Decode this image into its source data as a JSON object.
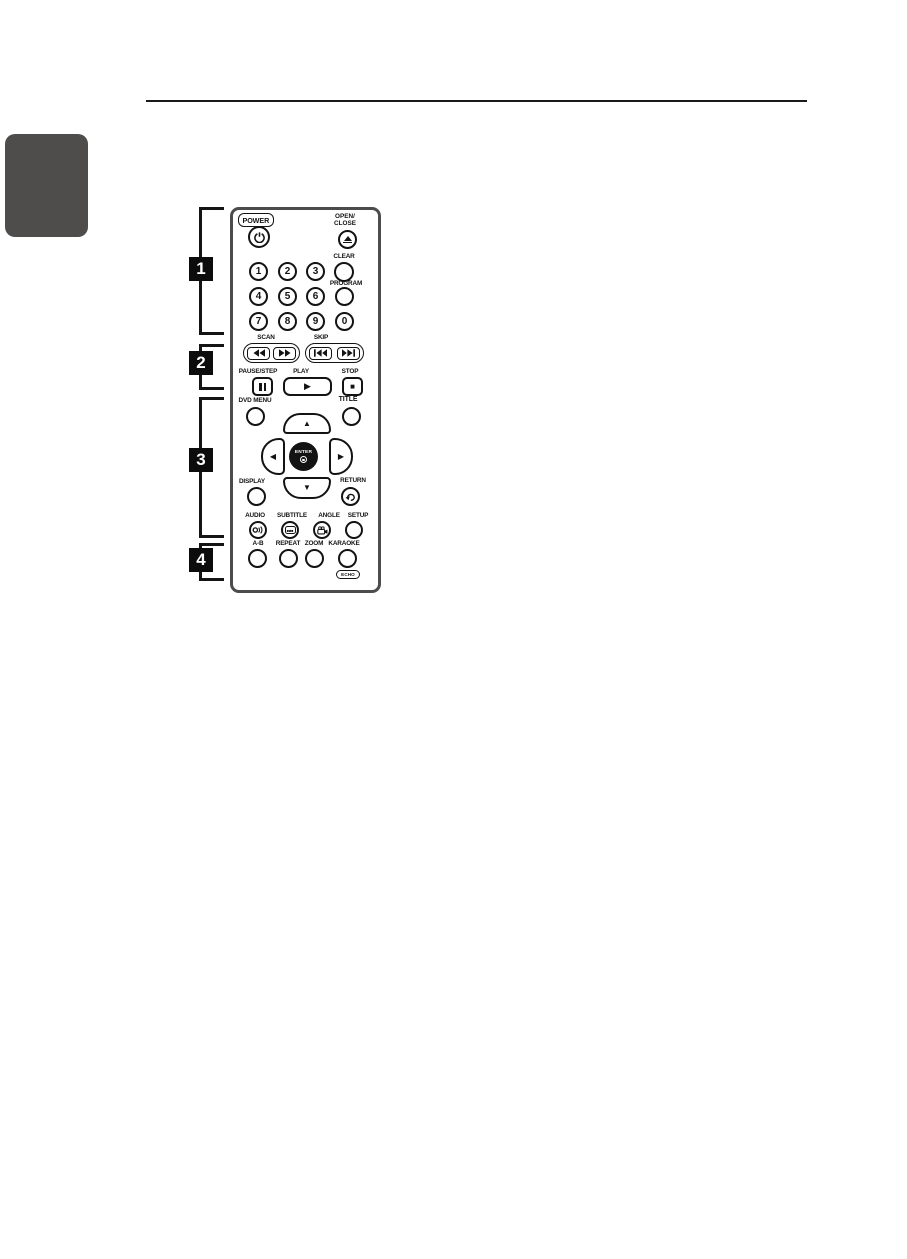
{
  "page": {
    "sections": [
      {
        "number": "1"
      },
      {
        "number": "2"
      },
      {
        "number": "3"
      },
      {
        "number": "4"
      }
    ]
  },
  "remote": {
    "power_label": "POWER",
    "open_close_line1": "OPEN/",
    "open_close_line2": "CLOSE",
    "digits": [
      "1",
      "2",
      "3",
      "4",
      "5",
      "6",
      "7",
      "8",
      "9",
      "0"
    ],
    "clear_label": "CLEAR",
    "program_label": "PROGRAM",
    "scan_label": "SCAN",
    "skip_label": "SKIP",
    "pause_step_label": "PAUSE/STEP",
    "play_label": "PLAY",
    "stop_label": "STOP",
    "dvd_menu_label": "DVD MENU",
    "title_label": "TITLE",
    "enter_label": "ENTER",
    "display_label": "DISPLAY",
    "return_label": "RETURN",
    "audio_label": "AUDIO",
    "subtitle_label": "SUBTITLE",
    "angle_label": "ANGLE",
    "setup_label": "SETUP",
    "ab_label": "A-B",
    "repeat_label": "REPEAT",
    "zoom_label": "ZOOM",
    "karaoke_label": "KARAOKE",
    "echo_label": "ECHO"
  },
  "icons": {
    "power": "⏻",
    "eject": "⏏",
    "rewind": "◀◀",
    "fast_forward": "▶▶",
    "skip_back": "|◀◀",
    "skip_forward": "▶▶|",
    "pause": "❚❚",
    "play": "▶",
    "stop": "■",
    "dpad_up": "▲",
    "dpad_down": "▼",
    "dpad_left": "◀",
    "dpad_right": "▶",
    "return": "↶"
  },
  "colors": {
    "ink": "#131313",
    "side_tab": "#4f4c4c",
    "remote_border": "#4c4c4c"
  }
}
